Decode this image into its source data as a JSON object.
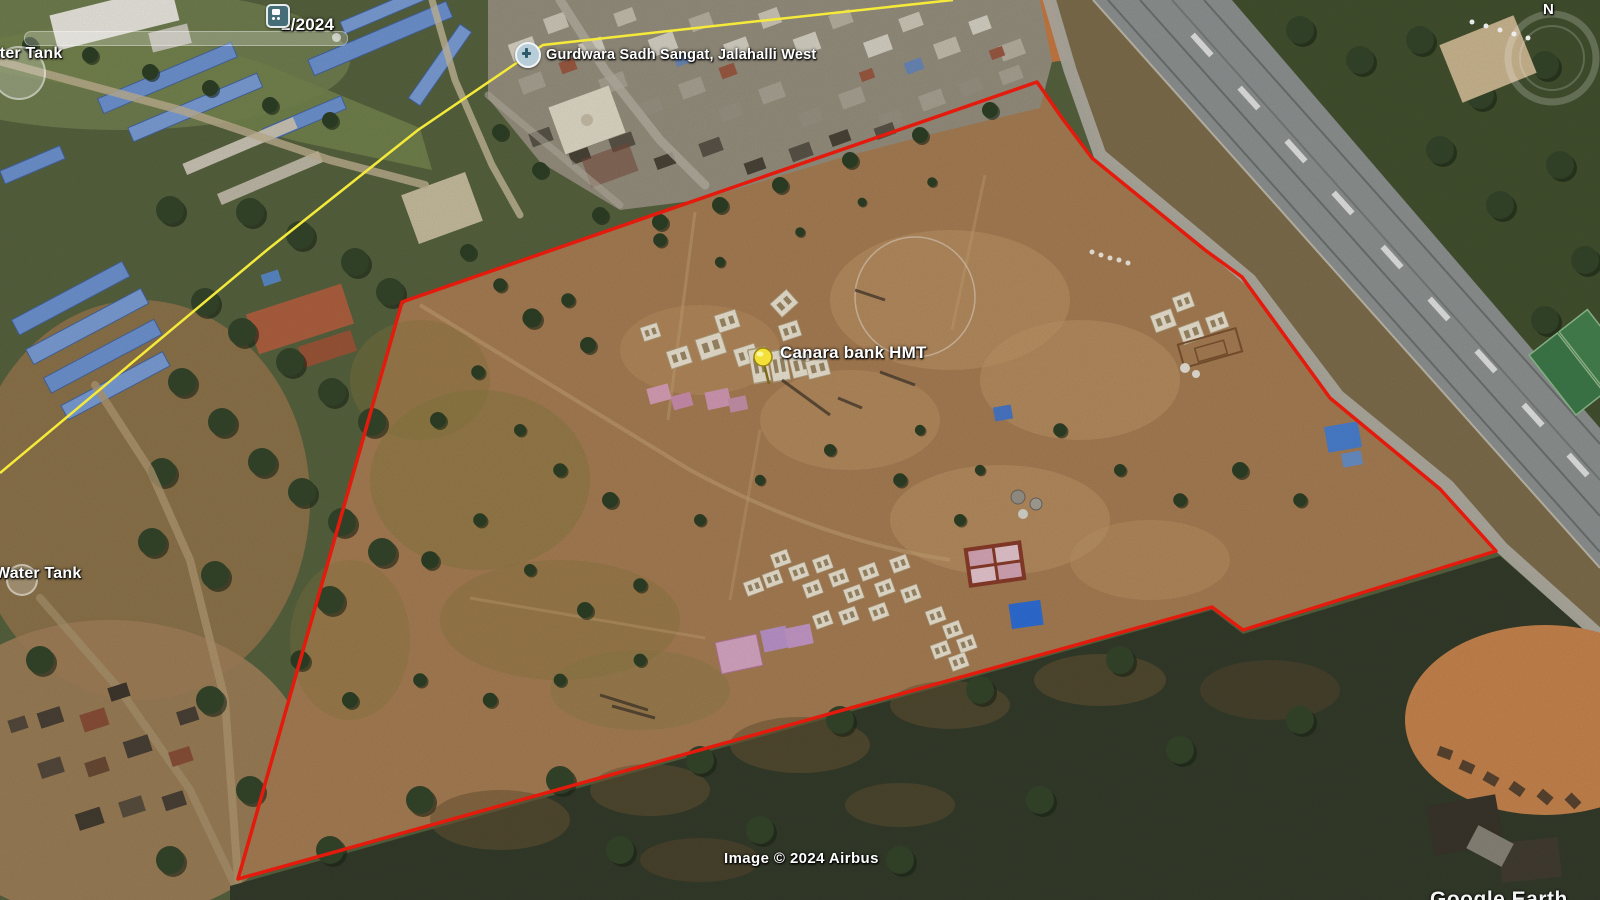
{
  "overlay": {
    "imagery_date": "2/2024"
  },
  "labels": {
    "water_tank_top": "Water Tank",
    "water_tank_mid": "Water Tank",
    "gurdwara": "Gurdwara Sadh Sangat, Jalahalli West",
    "canara_bank": "Canara bank HMT"
  },
  "footer": {
    "attribution": "Image © 2024 Airbus",
    "watermark": "Google Earth"
  },
  "compass": {
    "north_label": "N"
  },
  "colors": {
    "boundary_polygon": "#e31a0c",
    "survey_path_line": "#f5ea3a",
    "pushpin": "#f3e13a",
    "parcel_dirt": "#a87e54",
    "bus_stop_icon": "#456e79",
    "gurdwara_icon": "#b7cdd8"
  }
}
